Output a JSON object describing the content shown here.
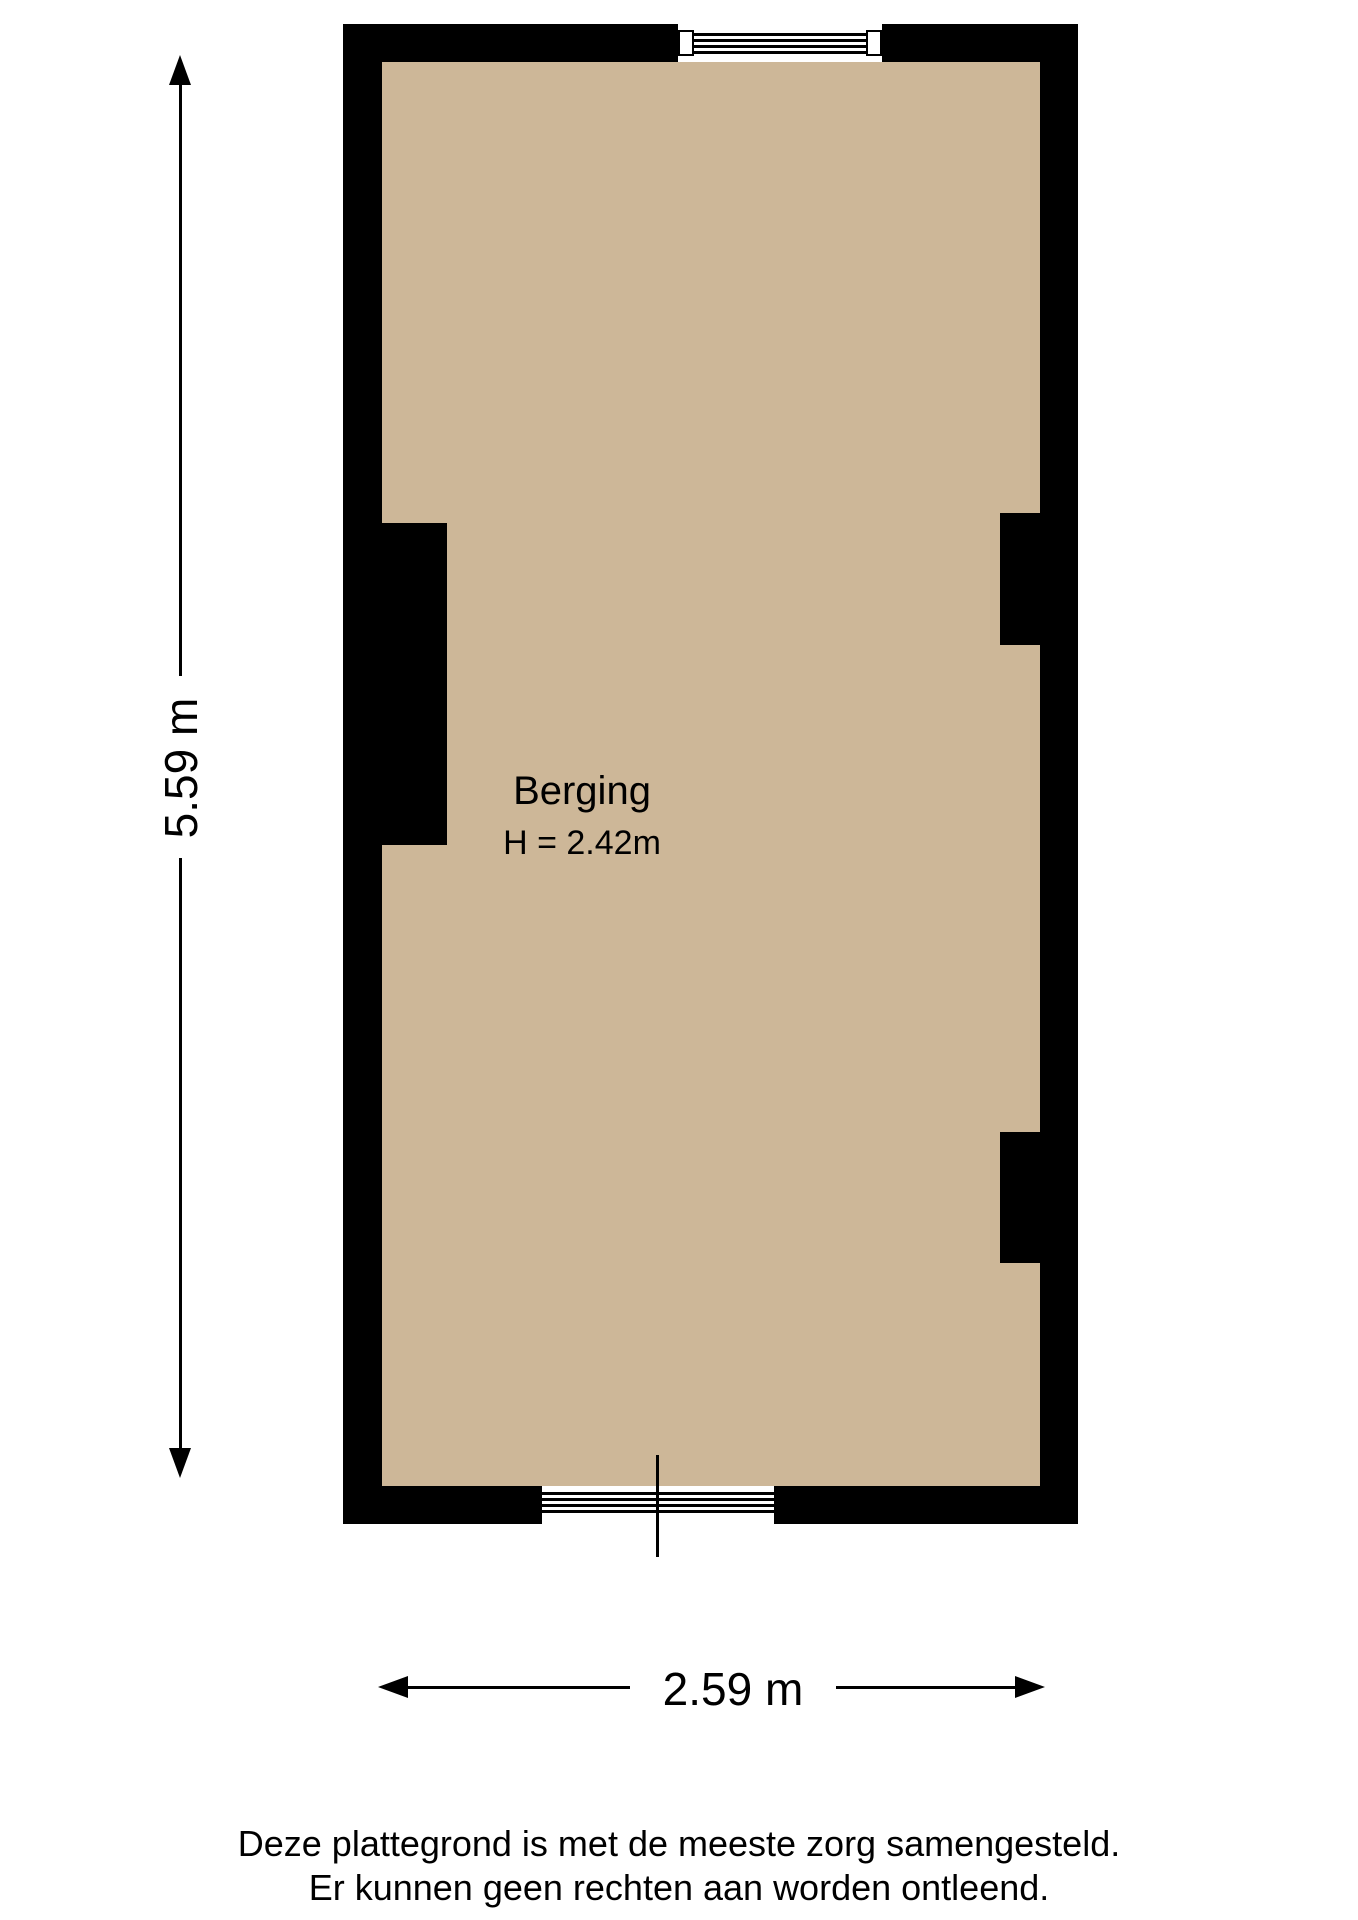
{
  "floorplan": {
    "room": {
      "name": "Berging",
      "height_text": "H = 2.42m"
    },
    "dimensions": {
      "vertical": "5.59 m",
      "horizontal": "2.59 m"
    },
    "colors": {
      "floor": "#cdb798",
      "wall": "#000000"
    }
  },
  "footer": {
    "line1": "Deze plattegrond is met de meeste zorg samengesteld.",
    "line2": "Er kunnen geen rechten aan worden ontleend."
  }
}
